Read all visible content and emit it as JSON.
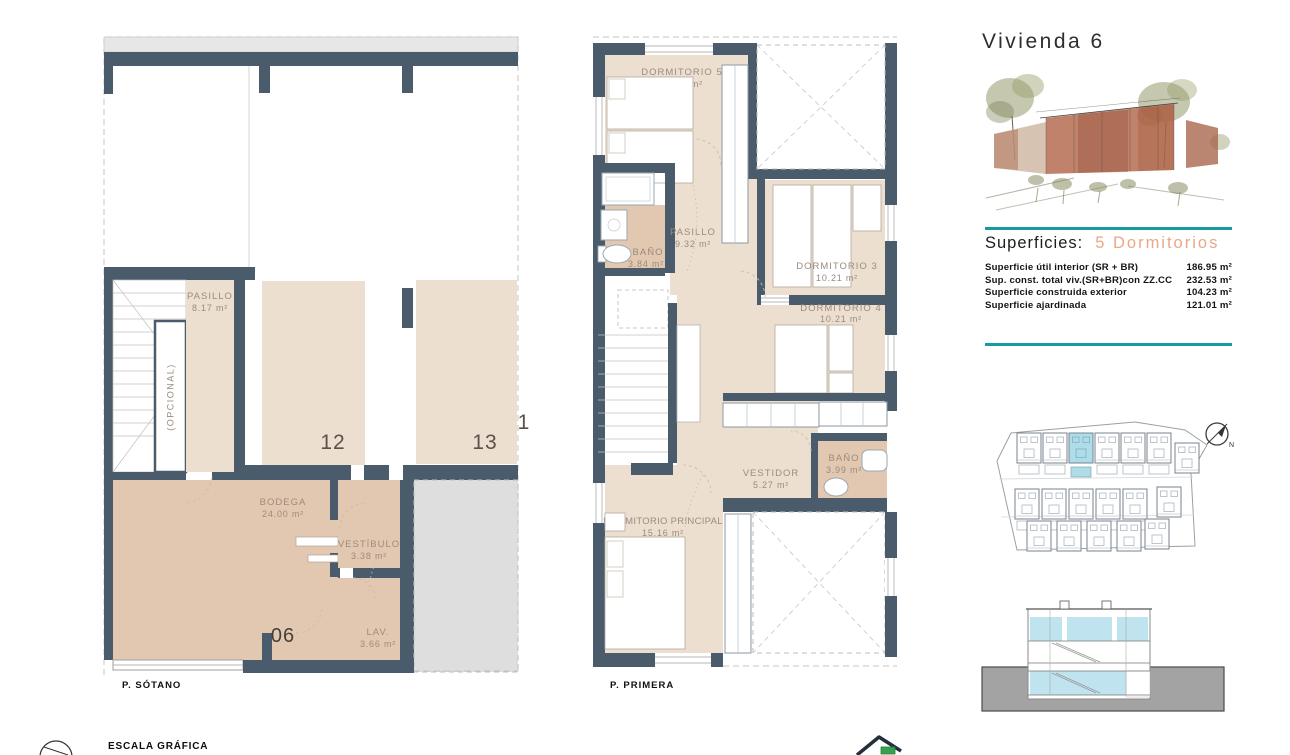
{
  "header": {
    "title": "Vivienda 6"
  },
  "superficies": {
    "heading": "Superficies:",
    "subtitle": "5 Dormitorios",
    "rows": [
      {
        "label": "Superficie útil interior (SR + BR)",
        "value": "186.95 m²"
      },
      {
        "label": "Sup. const. total viv.(SR+BR)con ZZ.CC",
        "value": "232.53 m²"
      },
      {
        "label": "Superficie construida exterior",
        "value": "104.23 m²"
      },
      {
        "label": "Superficie ajardinada",
        "value": "121.01 m²"
      }
    ]
  },
  "plans": {
    "sotano": {
      "label": "P. SÓTANO",
      "rooms": {
        "pasillo": {
          "name": "PASILLO",
          "area": "8.17 m²"
        },
        "opcional": {
          "name": "(OPCIONAL)"
        },
        "bodega": {
          "name": "BODEGA",
          "area": "24.00 m²"
        },
        "vestibulo": {
          "name": "VESTÍBULO",
          "area": "3.38 m²"
        },
        "lav": {
          "name": "LAV.",
          "area": "3.66 m²"
        }
      },
      "parking": {
        "left": "12",
        "right": "13",
        "partial": "1"
      },
      "unit_number": "06"
    },
    "primera": {
      "label": "P. PRIMERA",
      "rooms": {
        "dorm5": {
          "name": "DORMITORIO 5",
          "area": "10.80 m²"
        },
        "bano1": {
          "name": "BAÑO",
          "area": "3.84 m²"
        },
        "pasillo": {
          "name": "PASILLO",
          "area": "9.32 m²"
        },
        "dorm3": {
          "name": "DORMITORIO 3",
          "area": "10.21 m²"
        },
        "dorm4": {
          "name": "DORMITORIO 4",
          "area": "10.21 m²"
        },
        "bano2": {
          "name": "BAÑO",
          "area": "3.99 m²"
        },
        "vestidor": {
          "name": "VESTIDOR",
          "area": "5.27 m²"
        },
        "principal": {
          "name": "DORMITORIO PRINCIPAL",
          "area": "15.16 m²"
        }
      }
    }
  },
  "site_plan": {
    "compass_label": "N"
  },
  "footer": {
    "escala_label": "ESCALA GRÁFICA"
  },
  "colors": {
    "wall": "#4A5C6B",
    "floor_light": "#EDDFD0",
    "floor_dark": "#E3C8B1",
    "accent_teal": "#1999A0",
    "accent_orange": "#EBA887",
    "highlight_blue": "#AEDCE8",
    "ground_gray": "#A3A3A3"
  }
}
